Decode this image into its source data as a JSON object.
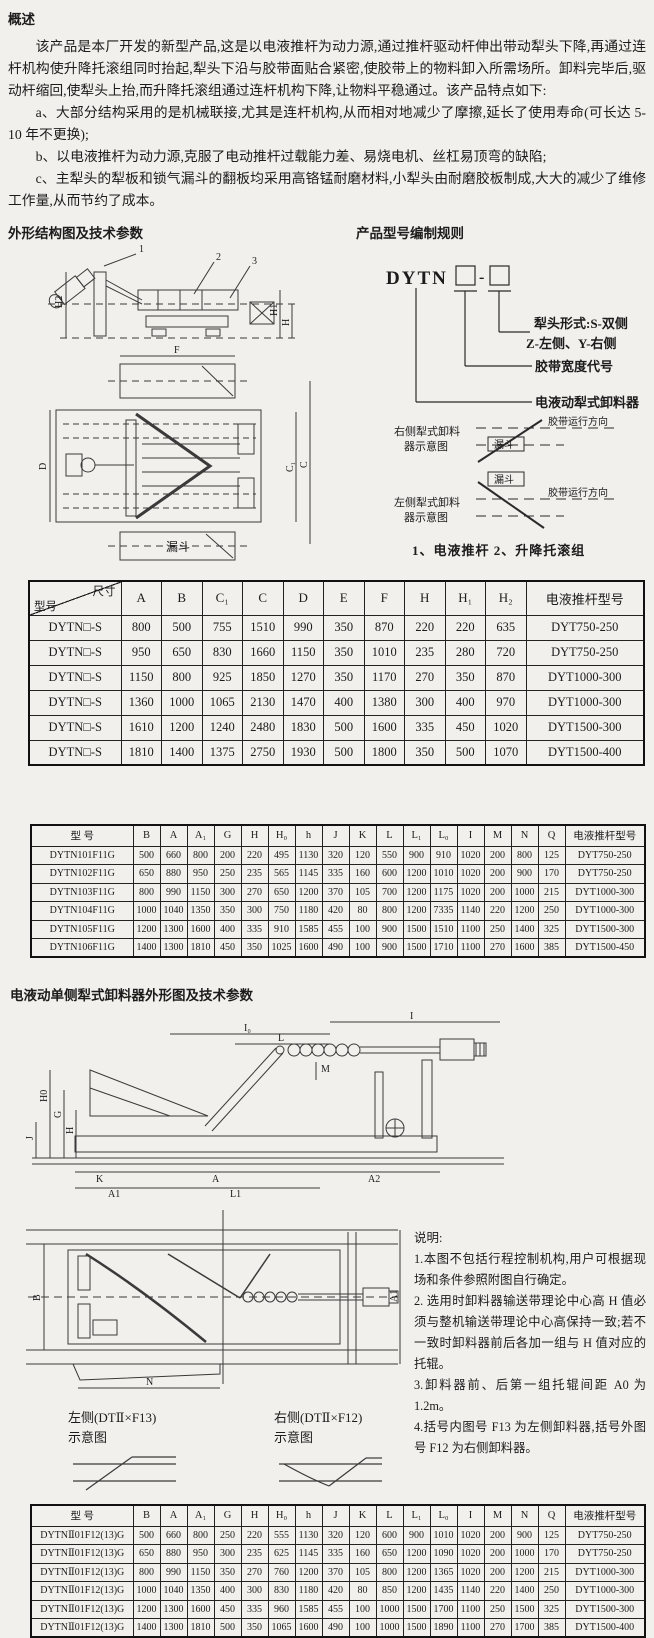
{
  "overview": {
    "heading": "概述",
    "paragraphs": [
      "该产品是本厂开发的新型产品,这是以电液推杆为动力源,通过推杆驱动杆伸出带动犁头下降,再通过连杆机构使升降托滚组同时抬起,犁头下沿与胶带面贴合紧密,使胶带上的物料卸入所需场所。卸料完毕后,驱动杆缩回,使犁头上抬,而升降托滚组通过连杆机构下降,让物料平稳通过。该产品特点如下:",
      "a、大部分结构采用的是机械联接,尤其是连杆机构,从而相对地减少了摩擦,延长了使用寿命(可长达 5-10 年不更换);",
      "b、以电液推杆为动力源,克服了电动推杆过载能力差、易烧电机、丝杠易顶弯的缺陷;",
      "c、主犁头的犁板和锁气漏斗的翻板均采用高铬锰耐磨材料,小犁头由耐磨胶板制成,大大的减少了维修工作量,从而节约了成本。"
    ]
  },
  "outline_section": {
    "heading": "外形结构图及技术参数"
  },
  "structural_drawing": {
    "callout_1": "1",
    "callout_2": "2",
    "callout_3": "3",
    "dim_h2": "H2",
    "dim_h1": "H1",
    "dim_h": "H",
    "dim_f": "F",
    "dim_d": "D",
    "dim_c1": "C₁",
    "dim_c": "C",
    "hopper": "漏斗"
  },
  "model_rule": {
    "heading": "产品型号编制规则",
    "code": "DYTN",
    "dash": "-",
    "labels": {
      "plow_form": "犁头形式:S-双侧",
      "plow_form2": "Z-左侧、Y-右侧",
      "belt_width": "胶带宽度代号",
      "product": "电液动犁式卸料器"
    },
    "right_schematic": {
      "title1": "右侧犁式卸料",
      "title2": "器示意图",
      "belt_dir": "胶带运行方向",
      "hopper": "漏斗"
    },
    "left_schematic": {
      "title1": "左侧犁式卸料",
      "title2": "器示意图",
      "belt_dir": "胶带运行方向",
      "hopper": "漏斗"
    },
    "legend": "1、电液推杆  2、升降托滚组"
  },
  "table1": {
    "corner": {
      "top": "尺寸",
      "bottom": "型号"
    },
    "columns": [
      "A",
      "B",
      "C₁",
      "C",
      "D",
      "E",
      "F",
      "H",
      "H₁",
      "H₂",
      "电液推杆型号"
    ],
    "rows": [
      {
        "model": "DYTN□-S",
        "values": [
          800,
          500,
          755,
          1510,
          990,
          350,
          870,
          220,
          220,
          635,
          "DYT750-250"
        ]
      },
      {
        "model": "DYTN□-S",
        "values": [
          950,
          650,
          830,
          1660,
          1150,
          350,
          1010,
          235,
          280,
          720,
          "DYT750-250"
        ]
      },
      {
        "model": "DYTN□-S",
        "values": [
          1150,
          800,
          925,
          1850,
          1270,
          350,
          1170,
          270,
          350,
          870,
          "DYT1000-300"
        ]
      },
      {
        "model": "DYTN□-S",
        "values": [
          1360,
          1000,
          1065,
          2130,
          1470,
          400,
          1380,
          300,
          400,
          970,
          "DYT1000-300"
        ]
      },
      {
        "model": "DYTN□-S",
        "values": [
          1610,
          1200,
          1240,
          2480,
          1830,
          500,
          1600,
          335,
          450,
          1020,
          "DYT1500-300"
        ]
      },
      {
        "model": "DYTN□-S",
        "values": [
          1810,
          1400,
          1375,
          2750,
          1930,
          500,
          1800,
          350,
          500,
          1070,
          "DYT1500-400"
        ]
      }
    ]
  },
  "table2": {
    "model_header": "型    号",
    "columns": [
      "B",
      "A",
      "A₁",
      "G",
      "H",
      "H₀",
      "h",
      "J",
      "K",
      "L",
      "L₁",
      "L₀",
      "I",
      "M",
      "N",
      "Q",
      "电液推杆型号"
    ],
    "rows": [
      {
        "model": "DYTN101F11G",
        "values": [
          500,
          660,
          800,
          200,
          220,
          495,
          1130,
          320,
          120,
          550,
          900,
          910,
          1020,
          200,
          800,
          125,
          "DYT750-250"
        ]
      },
      {
        "model": "DYTN102F11G",
        "values": [
          650,
          880,
          950,
          250,
          235,
          565,
          1145,
          335,
          160,
          600,
          1200,
          1010,
          1020,
          200,
          900,
          170,
          "DYT750-250"
        ]
      },
      {
        "model": "DYTN103F11G",
        "values": [
          800,
          990,
          1150,
          300,
          270,
          650,
          1200,
          370,
          105,
          700,
          1200,
          1175,
          1020,
          200,
          1000,
          215,
          "DYT1000-300"
        ]
      },
      {
        "model": "DYTN104F11G",
        "values": [
          1000,
          1040,
          1350,
          350,
          300,
          750,
          1180,
          420,
          80,
          800,
          1200,
          7335,
          1140,
          220,
          1200,
          250,
          "DYT1000-300"
        ]
      },
      {
        "model": "DYTN105F11G",
        "values": [
          1200,
          1300,
          1600,
          400,
          335,
          910,
          1585,
          455,
          100,
          900,
          1500,
          1510,
          1100,
          250,
          1400,
          325,
          "DYT1500-300"
        ]
      },
      {
        "model": "DYTN106F11G",
        "values": [
          1400,
          1300,
          1810,
          450,
          350,
          1025,
          1600,
          490,
          100,
          900,
          1500,
          1710,
          1100,
          270,
          1600,
          385,
          "DYT1500-450"
        ]
      }
    ]
  },
  "single_section": {
    "heading": "电液动单侧犁式卸料器外形图及技术参数"
  },
  "side_view_dims": {
    "i": "I",
    "i0": "I₀",
    "l": "L",
    "m": "M",
    "h0": "H0",
    "g": "G",
    "h": "H",
    "j": "J",
    "k": "K",
    "a": "A",
    "a2": "A2",
    "a1": "A1",
    "l1": "L1"
  },
  "plan_view_dims": {
    "b": "B",
    "n": "N",
    "a1": "A1"
  },
  "notes": {
    "heading": "说明:",
    "items": [
      "1.本图不包括行程控制机构,用户可根据现场和条件参照附图自行确定。",
      "2. 选用时卸料器输送带理论中心高 H 值必须与整机输送带理论中心高保持一致;若不一致时卸料器前后各加一组与 H 值对应的托辊。",
      "3.卸料器前、后第一组托辊间距 A0 为 1.2m。",
      "4.括号内图号 F13 为左侧卸料器,括号外图号 F12 为右侧卸料器。"
    ]
  },
  "side_diagrams": {
    "left_title": "左侧(DTⅡ×F13)",
    "right_title": "右侧(DTⅡ×F12)",
    "caption": "示意图"
  },
  "table3": {
    "model_header": "型    号",
    "columns": [
      "B",
      "A",
      "A₁",
      "G",
      "H",
      "H₀",
      "h",
      "J",
      "K",
      "L",
      "L₁",
      "L₀",
      "I",
      "M",
      "N",
      "Q",
      "电液推杆型号"
    ],
    "rows": [
      {
        "model": "DYTNⅡ01F12(13)G",
        "values": [
          500,
          660,
          800,
          250,
          220,
          555,
          1130,
          320,
          120,
          600,
          900,
          1010,
          1020,
          200,
          900,
          125,
          "DYT750-250"
        ]
      },
      {
        "model": "DYTNⅡ01F12(13)G",
        "values": [
          650,
          880,
          950,
          300,
          235,
          625,
          1145,
          335,
          160,
          650,
          1200,
          1090,
          1020,
          200,
          1000,
          170,
          "DYT750-250"
        ]
      },
      {
        "model": "DYTNⅡ01F12(13)G",
        "values": [
          800,
          990,
          1150,
          350,
          270,
          760,
          1200,
          370,
          105,
          800,
          1200,
          1365,
          1020,
          200,
          1200,
          215,
          "DYT1000-300"
        ]
      },
      {
        "model": "DYTNⅡ01F12(13)G",
        "values": [
          1000,
          1040,
          1350,
          400,
          300,
          830,
          1180,
          420,
          80,
          850,
          1200,
          1435,
          1140,
          220,
          1400,
          250,
          "DYT1000-300"
        ]
      },
      {
        "model": "DYTNⅡ01F12(13)G",
        "values": [
          1200,
          1300,
          1600,
          450,
          335,
          960,
          1585,
          455,
          100,
          1000,
          1500,
          1700,
          1100,
          250,
          1500,
          325,
          "DYT1500-300"
        ]
      },
      {
        "model": "DYTNⅡ01F12(13)G",
        "values": [
          1400,
          1300,
          1810,
          500,
          350,
          1065,
          1600,
          490,
          100,
          1000,
          1500,
          1890,
          1100,
          270,
          1700,
          385,
          "DYT1500-400"
        ]
      }
    ]
  }
}
